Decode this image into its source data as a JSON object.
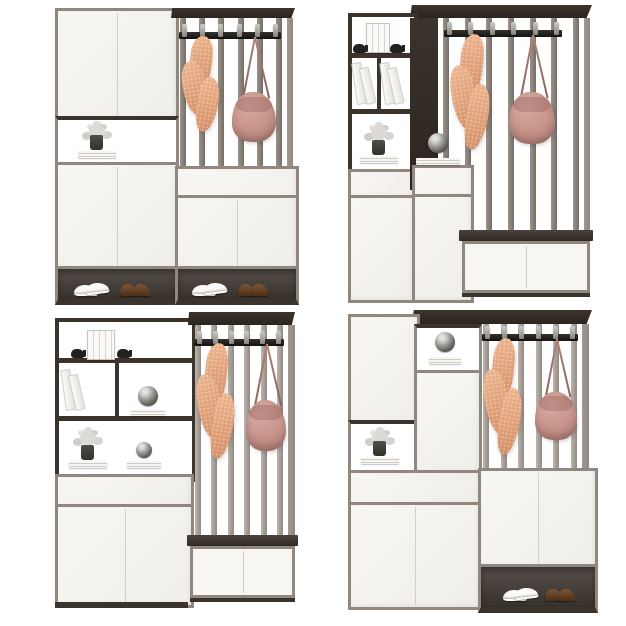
{
  "scene": {
    "type": "furniture-product-render",
    "description": "Four modern entryway hall-tree cabinet combinations arranged in a 2x2 grid on a white background. Each unit mixes white flat-front cabinets, dark wood open shelving niches, a vertical-slat coat-rack panel with a black six-hook rail, a hanging peach draped coat and a dusty-pink crossbody bag, decor items (white flower arrangements in dark vases, stacked and leaning books, black elephant bookends, smoked-glass orbs) and open shoe shelves holding white sneakers and brown shoes.",
    "grid": "2x2",
    "background": "#ffffff"
  },
  "palette": {
    "frame_wood": "#90887f",
    "dark_wood": "#3b342d",
    "panel_white": "#f7f6f3",
    "panel_border": "#d3d0ca",
    "seam": "#d2cfc9",
    "slat_dark_a": "#9b938b",
    "slat_dark_b": "#756e66",
    "slat_light_a": "#bcb6af",
    "slat_light_b": "#8f8982",
    "rail_a": "#35322f",
    "rail_b": "#151311",
    "hook_pin_a": "#cfcbc5",
    "hook_pin_b": "#87837d",
    "coat_a": "#edb791",
    "coat_b": "#e0a078",
    "coat_c": "#d18e66",
    "bag_a": "#d9aca3",
    "bag_b": "#c18d84",
    "bag_c": "#a8746b",
    "strap": "#b08379",
    "shoe_brown_a": "#7d5637",
    "shoe_brown_b": "#4c2f15",
    "sneaker_a": "#fbfaf8",
    "shelf_dark_a": "#57504a",
    "shelf_dark_b": "#37312c",
    "foliage_a": "#dbdad6",
    "foliage_b": "#d0cfcb",
    "vase_a": "#4c5046",
    "vase_b": "#2f322b"
  },
  "units": [
    {
      "id": "top-left",
      "rack": {
        "slat_count": 6,
        "hook_count": 6,
        "slat_tone": "dark"
      },
      "hanging": [
        "peach-coat",
        "pink-bag"
      ],
      "decor": [
        "flower-vase-on-books"
      ],
      "shoes": [
        "white-sneakers",
        "brown-shoes",
        "white-sneakers",
        "brown-shoes"
      ]
    },
    {
      "id": "top-right",
      "rack": {
        "slat_count": 7,
        "hook_count": 6,
        "slat_tone": "dark"
      },
      "hanging": [
        "peach-coat",
        "pink-bag"
      ],
      "decor": [
        "books-with-elephant-bookends",
        "leaning-books",
        "leaning-books",
        "flower-vase-on-books",
        "glass-orb-on-books"
      ],
      "shoes": []
    },
    {
      "id": "bottom-left",
      "rack": {
        "slat_count": 6,
        "hook_count": 6,
        "slat_tone": "light"
      },
      "hanging": [
        "peach-coat",
        "pink-bag"
      ],
      "decor": [
        "books-with-elephant-bookends",
        "leaning-books",
        "glass-orb-on-books",
        "flower-vase-on-books",
        "glass-orb-on-books"
      ],
      "shoes": []
    },
    {
      "id": "bottom-right",
      "rack": {
        "slat_count": 6,
        "hook_count": 6,
        "slat_tone": "light"
      },
      "hanging": [
        "peach-coat",
        "pink-bag"
      ],
      "decor": [
        "glass-orb-on-books",
        "flower-vase-on-books"
      ],
      "shoes": [
        "white-sneakers",
        "brown-shoes"
      ]
    }
  ]
}
